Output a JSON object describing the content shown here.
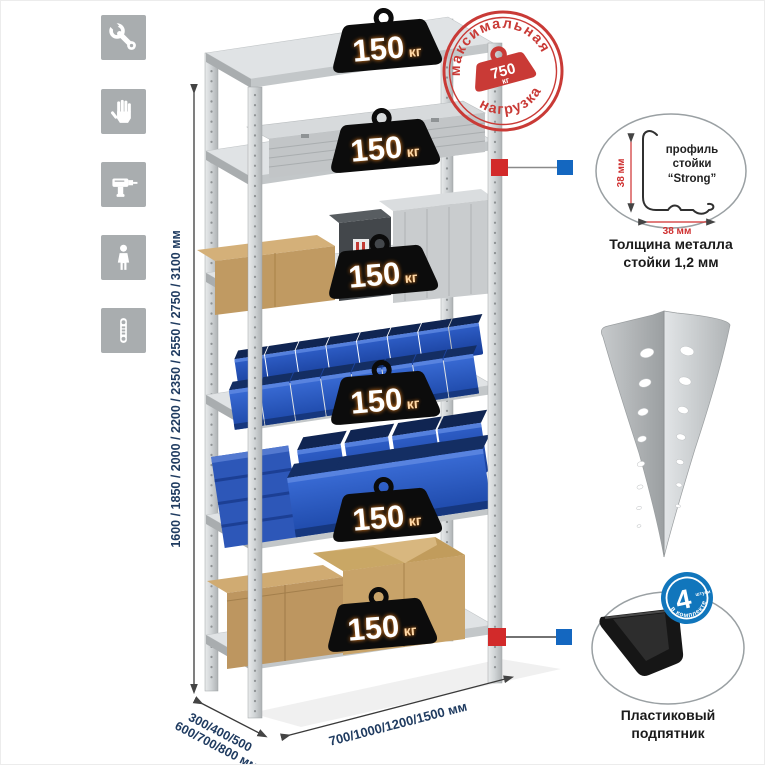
{
  "sidebar": {
    "icons": [
      {
        "name": "wrench-icon"
      },
      {
        "name": "glove-icon"
      },
      {
        "name": "drill-icon"
      },
      {
        "name": "person-icon"
      },
      {
        "name": "perforated-post-icon"
      }
    ]
  },
  "kettlebell": {
    "value": "150",
    "unit": "кг"
  },
  "stamp": {
    "top": "максимальная",
    "bottom": "нагрузка",
    "value": "750",
    "unit": "кг"
  },
  "dimensions": {
    "height": "1600 / 1850 / 2000 / 2200 / 2350 / 2550 / 2750 / 3100 мм",
    "depth_line1": "300/400/500",
    "depth_line2": "600/700/800 мм",
    "width": "700/1000/1200/1500 мм"
  },
  "profile_callout": {
    "label_line1": "профиль",
    "label_line2": "стойки",
    "label_line3": "“Strong”",
    "dim_vertical": "38 мм",
    "dim_horizontal": "38 мм",
    "caption_line1": "Толщина металла",
    "caption_line2": "стойки 1,2 мм"
  },
  "foot_callout": {
    "badge_value": "4",
    "badge_small": "штуки",
    "badge_curved": "в комплекте",
    "caption_line1": "Пластиковый",
    "caption_line2": "подпятник"
  },
  "colors": {
    "stamp_red": "#c93a36",
    "marker_red": "#d22a2a",
    "marker_blue": "#1467c0",
    "bin_blue": "#2a5bc4",
    "dim_text": "#1f3b60",
    "badge_blue": "#1176bc"
  }
}
